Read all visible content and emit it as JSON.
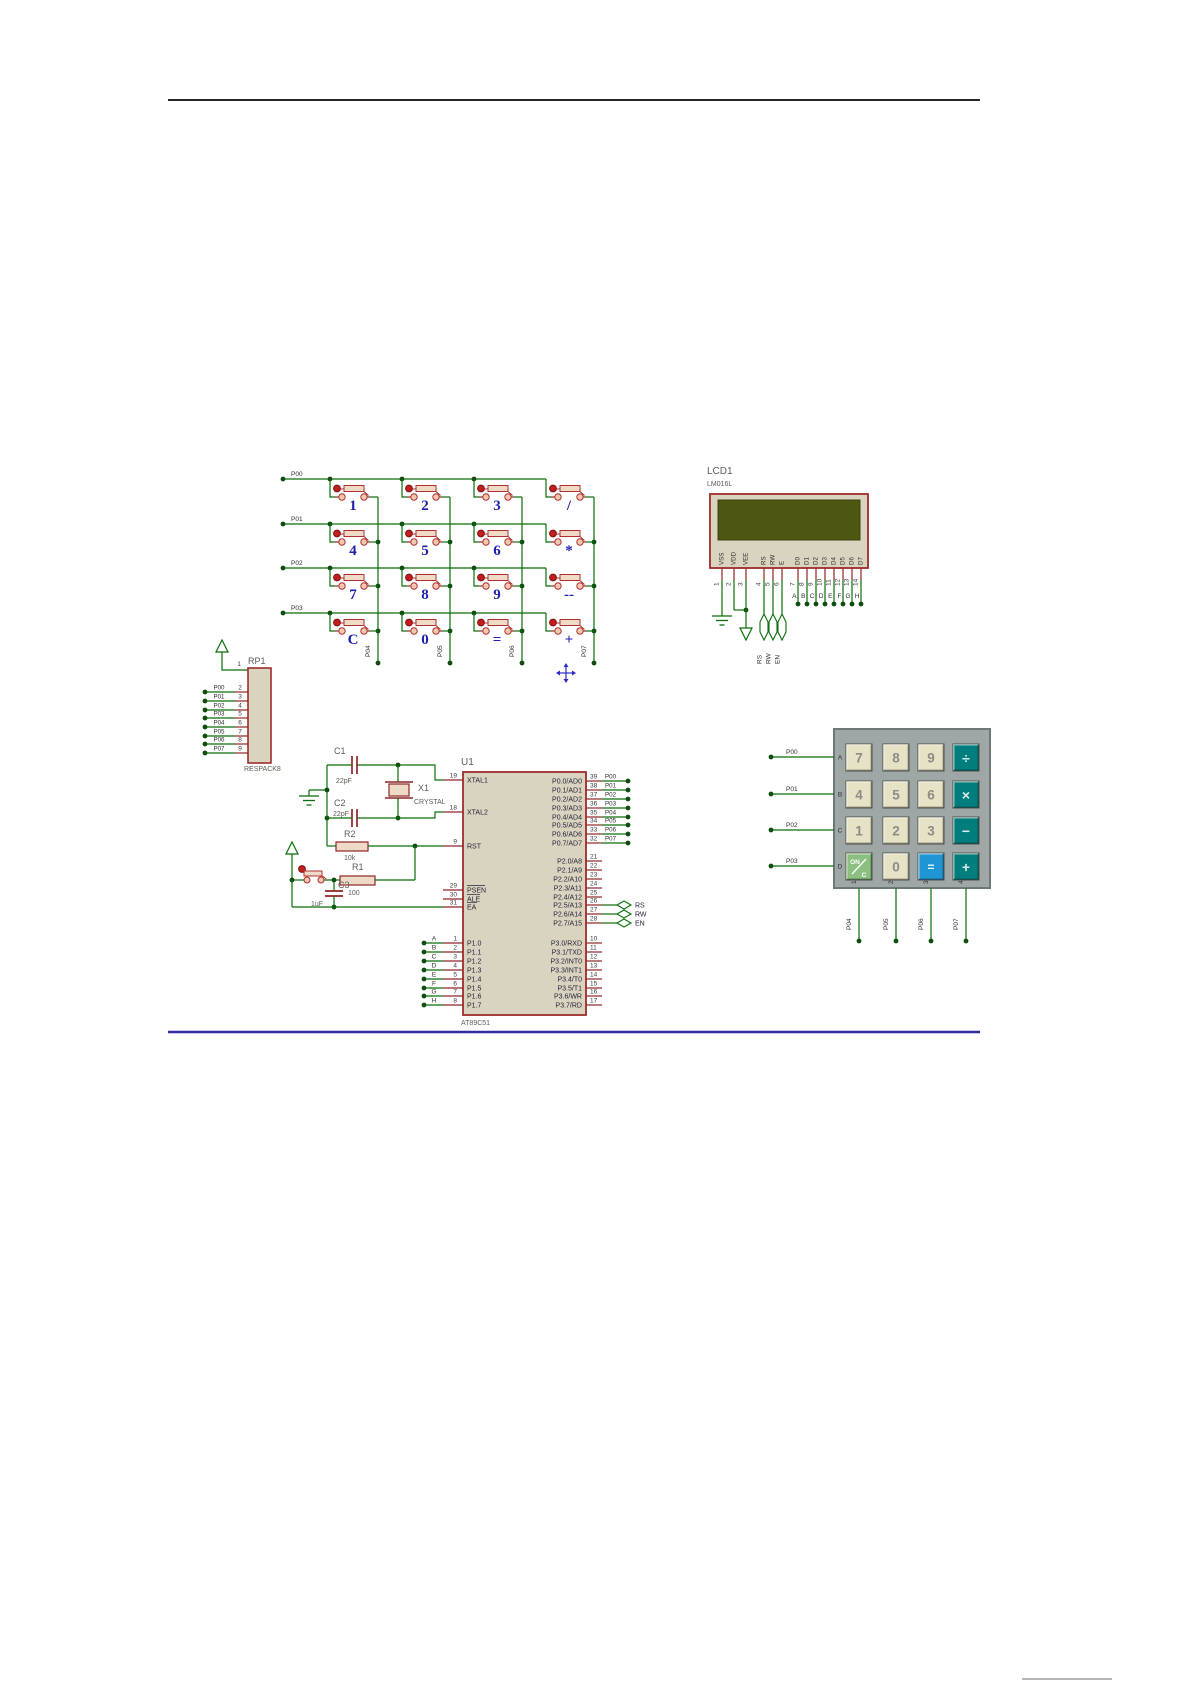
{
  "colors": {
    "wire": "#0a6e0a",
    "pin": "#8e2525",
    "dot": "#0d4d0d",
    "body_fill": "#d9d4bf",
    "body_border": "#9e2b2b",
    "screen": "#4d5711",
    "cap_fill": "#eddbc8",
    "btn_red": "#c41e1e",
    "term_fill": "#f0c8ae",
    "btn_stroke": "#b03030",
    "divider_top": "#262626",
    "divider_blue": "#2d2d9d",
    "divider_gray": "#b5b5b5",
    "marker_blue": "#2a2ac8",
    "calc_bezel": "#9ea6a6",
    "calc_bezel_border": "#6e7876",
    "calc_digit": "#e6e2c6",
    "calc_op": "#007d7d",
    "calc_eq": "#1f95d4",
    "calc_onc": "#8cc080"
  },
  "matrix": {
    "row_labels": [
      "P00",
      "P01",
      "P02",
      "P03"
    ],
    "col_labels": [
      "P04",
      "P05",
      "P06",
      "P07"
    ],
    "keys": [
      [
        "1",
        "2",
        "3",
        "/"
      ],
      [
        "4",
        "5",
        "6",
        "*"
      ],
      [
        "7",
        "8",
        "9",
        "--"
      ],
      [
        "C",
        "0",
        "=",
        "+"
      ]
    ]
  },
  "lcd": {
    "ref": "LCD1",
    "part": "LM016L",
    "pins": [
      "VSS",
      "VDD",
      "VEE",
      "RS",
      "RW",
      "E",
      "D0",
      "D1",
      "D2",
      "D3",
      "D4",
      "D5",
      "D6",
      "D7"
    ],
    "numbers": [
      "1",
      "2",
      "3",
      "4",
      "5",
      "6",
      "7",
      "8",
      "9",
      "10",
      "11",
      "12",
      "13",
      "14"
    ],
    "data_labels": [
      "A",
      "B",
      "C",
      "D",
      "E",
      "F",
      "G",
      "H"
    ],
    "taps": [
      "RS",
      "RW",
      "EN"
    ]
  },
  "respack": {
    "ref": "RP1",
    "part": "RESPACK8",
    "top_num": "1",
    "pins": [
      {
        "label": "P00",
        "num": "2"
      },
      {
        "label": "P01",
        "num": "3"
      },
      {
        "label": "P02",
        "num": "4"
      },
      {
        "label": "P03",
        "num": "5"
      },
      {
        "label": "P04",
        "num": "6"
      },
      {
        "label": "P05",
        "num": "7"
      },
      {
        "label": "P06",
        "num": "8"
      },
      {
        "label": "P07",
        "num": "9"
      }
    ]
  },
  "mcu": {
    "ref": "U1",
    "part": "AT89C51",
    "left_top": [
      {
        "name": "XTAL1",
        "num": "19"
      },
      {
        "name": "XTAL2",
        "num": "18"
      },
      {
        "name": "RST",
        "num": "9"
      }
    ],
    "left_ctrl": [
      {
        "name": "PSEN",
        "num": "29"
      },
      {
        "name": "ALE",
        "num": "30"
      },
      {
        "name": "EA",
        "num": "31"
      }
    ],
    "p1": [
      {
        "name": "P1.0",
        "num": "1",
        "label": "A"
      },
      {
        "name": "P1.1",
        "num": "2",
        "label": "B"
      },
      {
        "name": "P1.2",
        "num": "3",
        "label": "C"
      },
      {
        "name": "P1.3",
        "num": "4",
        "label": "D"
      },
      {
        "name": "P1.4",
        "num": "5",
        "label": "E"
      },
      {
        "name": "P1.5",
        "num": "6",
        "label": "F"
      },
      {
        "name": "P1.6",
        "num": "7",
        "label": "G"
      },
      {
        "name": "P1.7",
        "num": "8",
        "label": "H"
      }
    ],
    "p0": [
      {
        "name": "P0.0/AD0",
        "num": "39",
        "label": "P00"
      },
      {
        "name": "P0.1/AD1",
        "num": "38",
        "label": "P01"
      },
      {
        "name": "P0.2/AD2",
        "num": "37",
        "label": "P02"
      },
      {
        "name": "P0.3/AD3",
        "num": "36",
        "label": "P03"
      },
      {
        "name": "P0.4/AD4",
        "num": "35",
        "label": "P04"
      },
      {
        "name": "P0.5/AD5",
        "num": "34",
        "label": "P05"
      },
      {
        "name": "P0.6/AD6",
        "num": "33",
        "label": "P06"
      },
      {
        "name": "P0.7/AD7",
        "num": "32",
        "label": "P07"
      }
    ],
    "p2": [
      {
        "name": "P2.0/A8",
        "num": "21"
      },
      {
        "name": "P2.1/A9",
        "num": "22"
      },
      {
        "name": "P2.2/A10",
        "num": "23"
      },
      {
        "name": "P2.3/A11",
        "num": "24"
      },
      {
        "name": "P2.4/A12",
        "num": "25"
      },
      {
        "name": "P2.5/A13",
        "num": "26",
        "tap": "RS"
      },
      {
        "name": "P2.6/A14",
        "num": "27",
        "tap": "RW"
      },
      {
        "name": "P2.7/A15",
        "num": "28",
        "tap": "EN"
      }
    ],
    "p3": [
      {
        "name": "P3.0/RXD",
        "num": "10"
      },
      {
        "name": "P3.1/TXD",
        "num": "11"
      },
      {
        "name": "P3.2/INT0",
        "num": "12"
      },
      {
        "name": "P3.3/INT1",
        "num": "13"
      },
      {
        "name": "P3.4/T0",
        "num": "14"
      },
      {
        "name": "P3.5/T1",
        "num": "15"
      },
      {
        "name": "P3.6/WR",
        "num": "16"
      },
      {
        "name": "P3.7/RD",
        "num": "17"
      }
    ]
  },
  "parts": {
    "c1": {
      "ref": "C1",
      "value": "22pF"
    },
    "c2": {
      "ref": "C2",
      "value": "22pF"
    },
    "c3": {
      "ref": "C3",
      "value": "1uF"
    },
    "r1": {
      "ref": "R1",
      "value": "100"
    },
    "r2": {
      "ref": "R2",
      "value": "10k"
    },
    "x1": {
      "ref": "X1",
      "value": "CRYSTAL"
    }
  },
  "calc": {
    "row_labels": [
      "A",
      "B",
      "C",
      "D"
    ],
    "row_ports": [
      "P00",
      "P01",
      "P02",
      "P03"
    ],
    "col_ticks": [
      "1",
      "2",
      "3",
      "4"
    ],
    "col_ports": [
      "P04",
      "P05",
      "P06",
      "P07"
    ],
    "keys": [
      [
        {
          "label": "7",
          "type": "digit"
        },
        {
          "label": "8",
          "type": "digit"
        },
        {
          "label": "9",
          "type": "digit"
        },
        {
          "label": "÷",
          "type": "op"
        }
      ],
      [
        {
          "label": "4",
          "type": "digit"
        },
        {
          "label": "5",
          "type": "digit"
        },
        {
          "label": "6",
          "type": "digit"
        },
        {
          "label": "×",
          "type": "op"
        }
      ],
      [
        {
          "label": "1",
          "type": "digit"
        },
        {
          "label": "2",
          "type": "digit"
        },
        {
          "label": "3",
          "type": "digit"
        },
        {
          "label": "−",
          "type": "op"
        }
      ],
      [
        {
          "label": "ON/C",
          "type": "onc"
        },
        {
          "label": "0",
          "type": "digit"
        },
        {
          "label": "=",
          "type": "eq"
        },
        {
          "label": "+",
          "type": "op"
        }
      ]
    ]
  }
}
